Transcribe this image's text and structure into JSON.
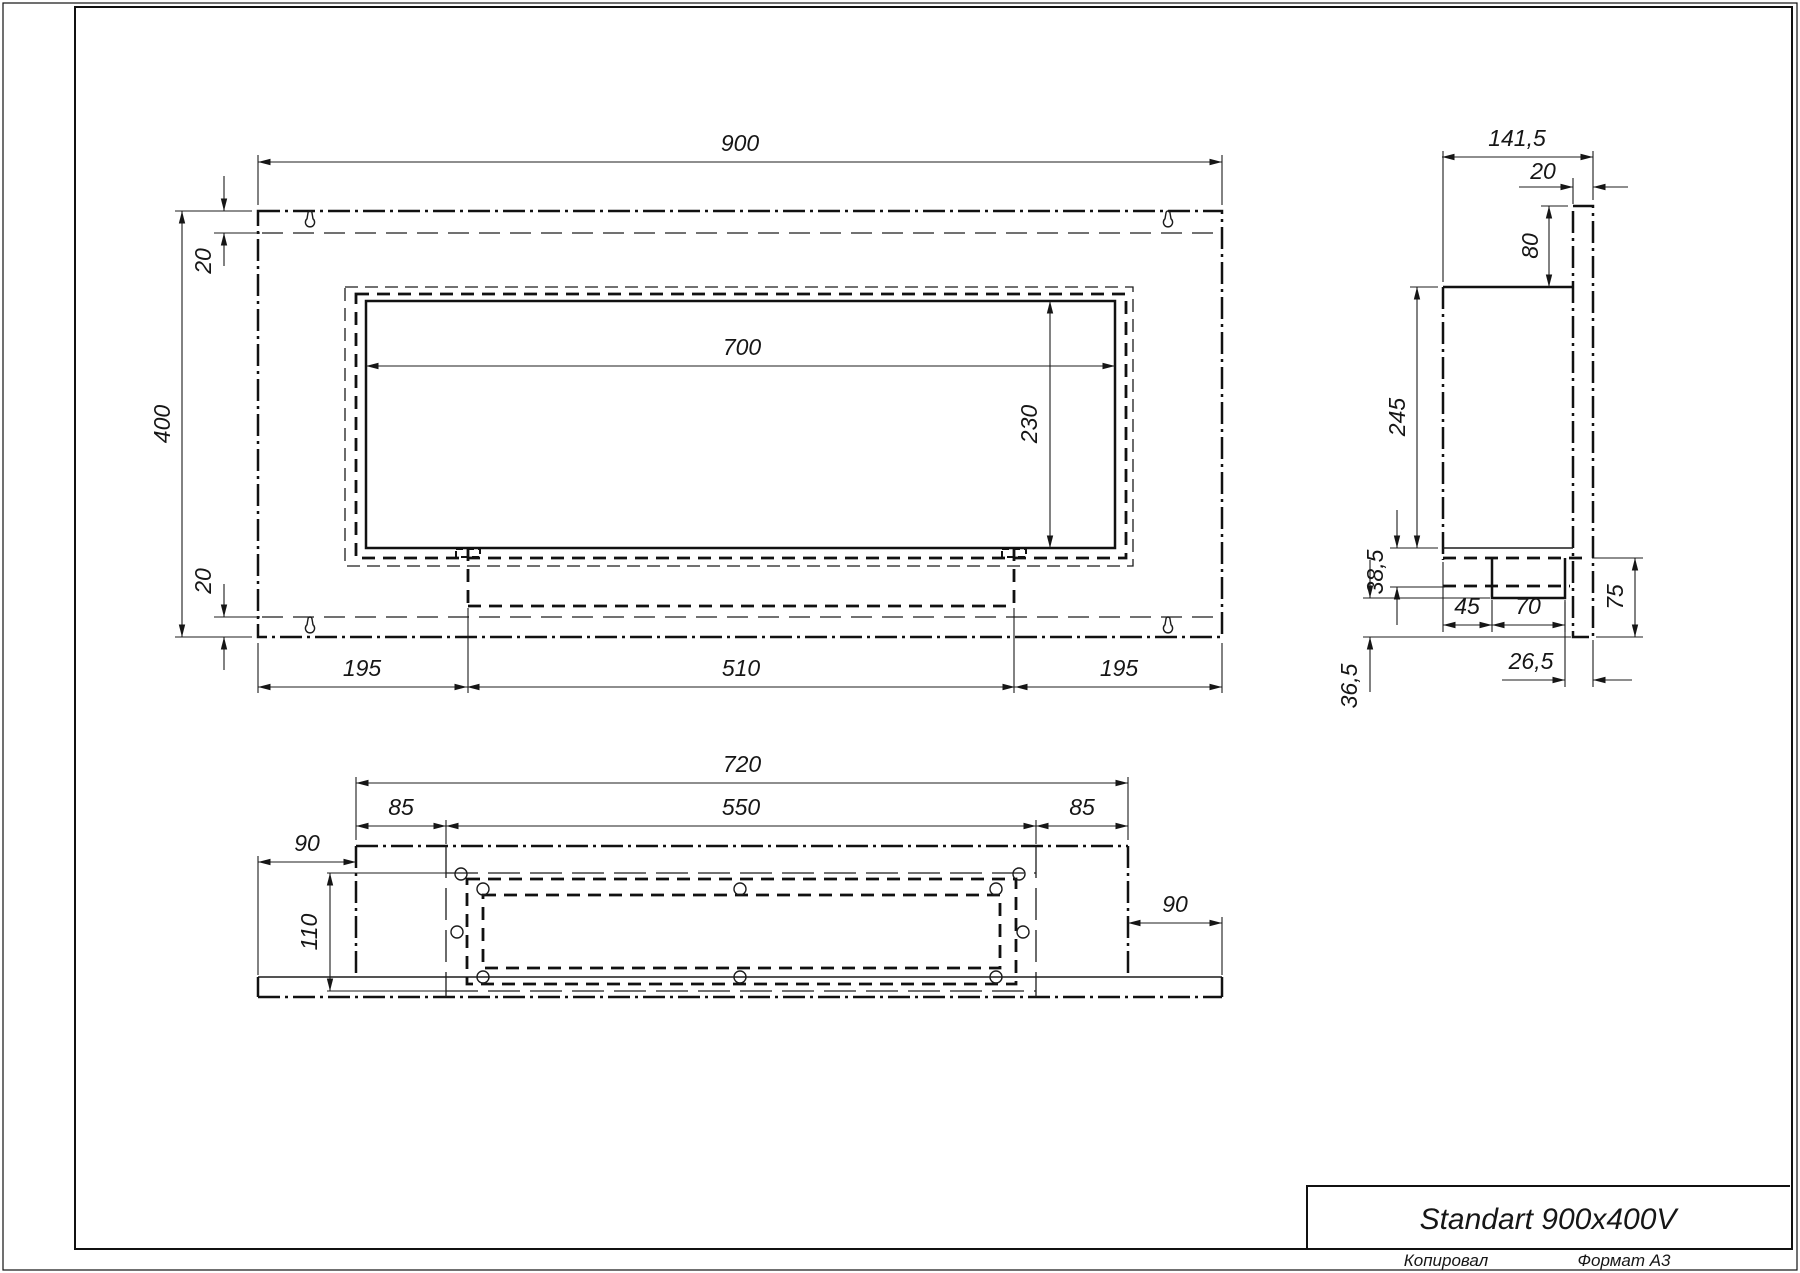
{
  "title": {
    "product": "Standart 900x400V",
    "copied": "Копировал",
    "format": "Формат А3"
  },
  "front": {
    "d900": "900",
    "d400": "400",
    "d20t": "20",
    "d20b": "20",
    "d700": "700",
    "d230": "230",
    "d195l": "195",
    "d510": "510",
    "d195r": "195"
  },
  "side": {
    "d1415": "141,5",
    "d20": "20",
    "d80": "80",
    "d245": "245",
    "d385": "38,5",
    "d45": "45",
    "d70": "70",
    "d75": "75",
    "d265": "26,5",
    "d365": "36,5"
  },
  "bottom": {
    "d720": "720",
    "d85l": "85",
    "d550": "550",
    "d85r": "85",
    "d90l": "90",
    "d110": "110",
    "d90r": "90"
  }
}
